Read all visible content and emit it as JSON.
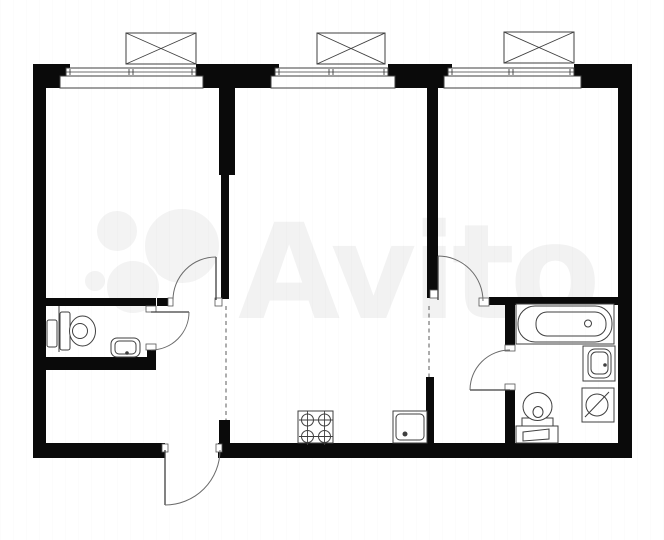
{
  "meta": {
    "title": "apartment-floor-plan",
    "canvas": {
      "w": 664,
      "h": 540
    }
  },
  "colors": {
    "wall": "#0a0a0a",
    "line": "#3f3f3f",
    "thin": "#6a6a6a",
    "jamb_stroke": "#555555",
    "watermark": "#f2f2f2",
    "watermark_circle": "#f3f3f3",
    "bg": "#ffffff"
  },
  "watermark": {
    "text": "Avito",
    "x": 238,
    "y": 318,
    "font_size": 132,
    "circles": [
      [
        117,
        231,
        21
      ],
      [
        182,
        246,
        38
      ],
      [
        133,
        287,
        27
      ],
      [
        95,
        281,
        11
      ]
    ]
  },
  "walls": [
    {
      "n": "outer-top-wall-left-corner",
      "r": [
        33,
        64,
        37,
        24
      ]
    },
    {
      "n": "outer-top-wall-seg-1",
      "r": [
        196,
        64,
        83,
        24
      ]
    },
    {
      "n": "outer-top-wall-seg-2",
      "r": [
        388,
        64,
        64,
        24
      ]
    },
    {
      "n": "outer-top-wall-right-corner",
      "r": [
        574,
        64,
        58,
        24
      ]
    },
    {
      "n": "outer-left-wall",
      "r": [
        33,
        64,
        13,
        394
      ]
    },
    {
      "n": "outer-right-wall",
      "r": [
        618,
        64,
        14,
        394
      ]
    },
    {
      "n": "outer-bottom-wall-left",
      "r": [
        33,
        443,
        132,
        15
      ]
    },
    {
      "n": "outer-bottom-wall-right",
      "r": [
        218,
        443,
        414,
        15
      ]
    },
    {
      "n": "divider-left-room-upper",
      "r": [
        219,
        88,
        16,
        87
      ]
    },
    {
      "n": "divider-left-room-lower",
      "r": [
        221,
        175,
        8,
        124
      ]
    },
    {
      "n": "divider-right-room",
      "r": [
        427,
        88,
        11,
        210
      ]
    },
    {
      "n": "wc-top-wall",
      "r": [
        46,
        298,
        110,
        8
      ]
    },
    {
      "n": "wc-top-wall-stub",
      "r": [
        157,
        298,
        11,
        8
      ]
    },
    {
      "n": "wc-bottom-wall",
      "r": [
        46,
        357,
        110,
        13
      ]
    },
    {
      "n": "wc-right-wall-stub",
      "r": [
        147,
        350,
        9,
        10
      ]
    },
    {
      "n": "bathroom-top-wall",
      "r": [
        489,
        297,
        129,
        8
      ]
    },
    {
      "n": "bathroom-left-wall-upper",
      "r": [
        505,
        305,
        10,
        42
      ]
    },
    {
      "n": "bathroom-left-wall-lower",
      "r": [
        505,
        390,
        10,
        53
      ]
    },
    {
      "n": "corridor-wall-lower",
      "r": [
        426,
        377,
        8,
        66
      ]
    },
    {
      "n": "hall-kitchen-wall-stub",
      "r": [
        219,
        420,
        11,
        23
      ]
    }
  ],
  "jambs": [
    {
      "n": "left-room-door-jamb-left",
      "r": [
        168,
        298,
        5,
        8
      ]
    },
    {
      "n": "left-room-door-jamb-right",
      "r": [
        215,
        298,
        7,
        8
      ]
    },
    {
      "n": "right-room-door-jamb-left",
      "r": [
        430,
        290,
        8,
        8
      ]
    },
    {
      "n": "right-room-door-jamb-right",
      "r": [
        479,
        298,
        10,
        8
      ]
    },
    {
      "n": "wc-door-jamb-top",
      "r": [
        146,
        306,
        10,
        6
      ]
    },
    {
      "n": "wc-door-jamb-bottom",
      "r": [
        146,
        344,
        10,
        6
      ]
    },
    {
      "n": "bathroom-door-jamb-top",
      "r": [
        505,
        345,
        10,
        6
      ]
    },
    {
      "n": "bathroom-door-jamb-bottom",
      "r": [
        505,
        384,
        10,
        6
      ]
    },
    {
      "n": "entrance-jamb-left",
      "r": [
        162,
        444,
        6,
        8
      ]
    },
    {
      "n": "entrance-jamb-right",
      "r": [
        216,
        444,
        6,
        8
      ]
    }
  ],
  "windows": [
    {
      "n": "window-1",
      "sill": [
        60,
        76,
        143,
        12
      ],
      "glaze": [
        66,
        68,
        130,
        8
      ],
      "mullion": 131
    },
    {
      "n": "window-2",
      "sill": [
        271,
        76,
        124,
        12
      ],
      "glaze": [
        275,
        68,
        113,
        8
      ],
      "mullion": 331
    },
    {
      "n": "window-3",
      "sill": [
        444,
        76,
        137,
        12
      ],
      "glaze": [
        448,
        68,
        126,
        8
      ],
      "mullion": 511
    }
  ],
  "ac_units": [
    {
      "n": "ac-unit-1",
      "r": [
        126,
        33,
        70,
        31
      ]
    },
    {
      "n": "ac-unit-2",
      "r": [
        317,
        33,
        68,
        31
      ]
    },
    {
      "n": "ac-unit-3",
      "r": [
        504,
        32,
        70,
        31
      ]
    }
  ],
  "dashed_openings": [
    {
      "n": "hall-kitchen-opening",
      "l": [
        226,
        306,
        226,
        420
      ]
    },
    {
      "n": "kitchen-corridor-opening",
      "l": [
        429,
        306,
        429,
        377
      ]
    }
  ],
  "doors": [
    {
      "n": "left-room-door",
      "leaf": [
        216,
        257,
        216,
        300
      ],
      "arc": "M 173,300 A 43 43 0 0 1 216,257"
    },
    {
      "n": "right-room-door",
      "leaf": [
        438,
        256,
        438,
        300
      ],
      "arc": "M 438,256 A 45 45 0 0 1 483,301"
    },
    {
      "n": "wc-door",
      "leaf": [
        151,
        312,
        189,
        312
      ],
      "arc": "M 189,312 A 38 38 0 0 1 151,350"
    },
    {
      "n": "bathroom-door",
      "leaf": [
        510,
        390,
        470,
        390
      ],
      "arc": "M 470,390 A 40 40 0 0 1 510,350"
    },
    {
      "n": "entrance-door",
      "leaf": [
        165,
        450,
        165,
        505
      ],
      "arc": "M 165,505 A 55 55 0 0 0 220,450"
    }
  ],
  "fixtures": [
    {
      "n": "wc-duct-line",
      "s": [
        {
          "t": "line",
          "p": [
            59,
            306,
            59,
            352
          ]
        }
      ]
    },
    {
      "n": "wc-water-heater",
      "s": [
        {
          "t": "rect",
          "p": [
            47,
            320,
            10,
            27
          ],
          "r": 2
        }
      ]
    },
    {
      "n": "wc-toilet",
      "s": [
        {
          "t": "rect",
          "p": [
            60,
            312,
            10,
            38
          ],
          "r": 2
        },
        {
          "t": "ellipse",
          "p": [
            82.5,
            331,
            13,
            15
          ]
        },
        {
          "t": "circle",
          "p": [
            80,
            331,
            7.5
          ]
        }
      ]
    },
    {
      "n": "wc-washbasin",
      "s": [
        {
          "t": "rect",
          "p": [
            111,
            338,
            29,
            19
          ],
          "r": 6
        },
        {
          "t": "rect",
          "p": [
            115,
            341,
            21,
            13
          ],
          "r": 4
        },
        {
          "t": "circle",
          "p": [
            127,
            353,
            1.8
          ],
          "f": 1
        }
      ]
    },
    {
      "n": "stove",
      "s": [
        {
          "t": "rect",
          "p": [
            298,
            411,
            35,
            32
          ]
        },
        {
          "t": "burner",
          "p": [
            307.5,
            420,
            6
          ]
        },
        {
          "t": "burner",
          "p": [
            324.5,
            420,
            6
          ]
        },
        {
          "t": "burner",
          "p": [
            307.5,
            436.5,
            6
          ]
        },
        {
          "t": "burner",
          "p": [
            324.5,
            436.5,
            6
          ]
        }
      ]
    },
    {
      "n": "kitchen-sink",
      "s": [
        {
          "t": "rect",
          "p": [
            393,
            411,
            34,
            32
          ]
        },
        {
          "t": "rect",
          "p": [
            396,
            414,
            28,
            26
          ],
          "r": 4
        },
        {
          "t": "circle",
          "p": [
            405,
            434,
            2.5
          ],
          "f": 1
        }
      ]
    },
    {
      "n": "bathtub",
      "s": [
        {
          "t": "rect",
          "p": [
            516,
            304,
            98,
            40
          ]
        },
        {
          "t": "rect",
          "p": [
            518,
            306,
            94,
            36
          ],
          "r": 17
        },
        {
          "t": "rect",
          "p": [
            536,
            312,
            70,
            24
          ],
          "r": 11
        },
        {
          "t": "circle",
          "p": [
            588,
            323.5,
            3.5
          ]
        }
      ]
    },
    {
      "n": "bathroom-washbasin",
      "s": [
        {
          "t": "rect",
          "p": [
            583,
            346,
            32,
            35
          ]
        },
        {
          "t": "rect",
          "p": [
            588,
            349,
            23,
            29
          ],
          "r": 7
        },
        {
          "t": "rect",
          "p": [
            591,
            352,
            17,
            22
          ],
          "r": 5
        },
        {
          "t": "circle",
          "p": [
            605,
            365,
            1.8
          ],
          "f": 1
        }
      ]
    },
    {
      "n": "washing-machine",
      "s": [
        {
          "t": "rect",
          "p": [
            582,
            388,
            32,
            34
          ]
        },
        {
          "t": "circle",
          "p": [
            597,
            405,
            11
          ]
        },
        {
          "t": "line",
          "p": [
            585,
            417,
            609,
            392
          ]
        }
      ]
    },
    {
      "n": "bathroom-toilet",
      "s": [
        {
          "t": "rect",
          "p": [
            522,
            418,
            31,
            10
          ]
        },
        {
          "t": "ellipse",
          "p": [
            537.5,
            406.5,
            14.5,
            14
          ]
        },
        {
          "t": "ellipse",
          "p": [
            538,
            412,
            5,
            5.5
          ]
        }
      ]
    },
    {
      "n": "bathroom-cabinet",
      "s": [
        {
          "t": "rect",
          "p": [
            516,
            426,
            42,
            17
          ]
        },
        {
          "t": "poly",
          "p": [
            523,
            432,
            549,
            429,
            549,
            439,
            523,
            441
          ]
        }
      ]
    }
  ]
}
